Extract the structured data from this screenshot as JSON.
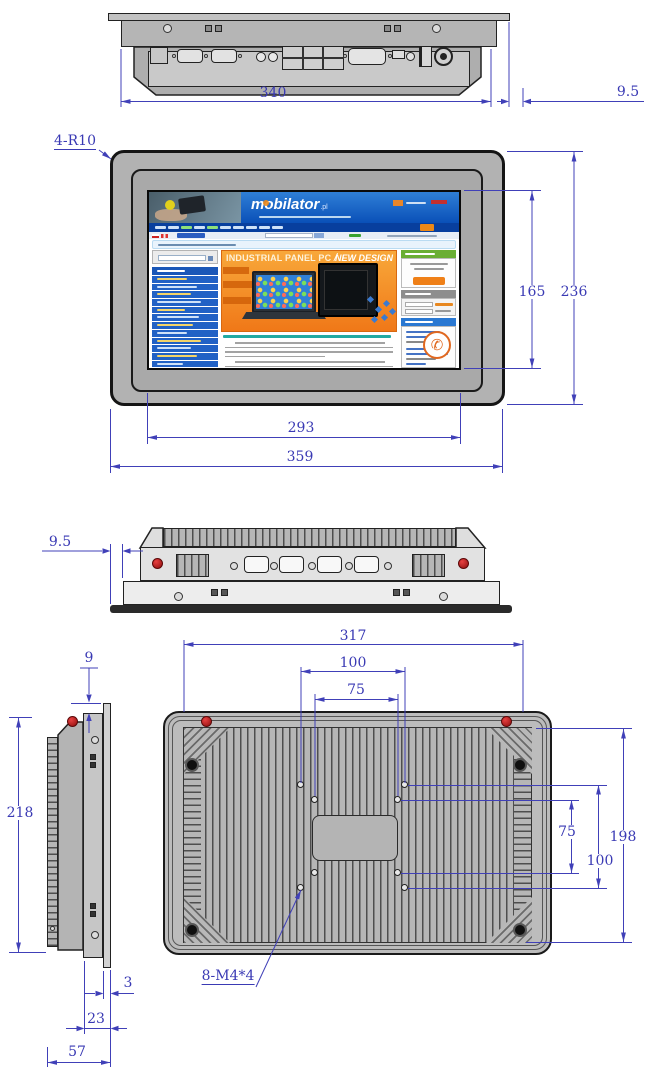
{
  "dims": {
    "top_width": "340",
    "top_lip": "9.5",
    "corner_radius": "4-R10",
    "screen_height": "165",
    "front_height": "236",
    "screen_width": "293",
    "front_width": "359",
    "side_lip": "9.5",
    "rear_offset": "9",
    "side_height": "218",
    "back_width": "317",
    "vesa_top_100": "100",
    "vesa_top_75": "75",
    "vesa_right_75": "75",
    "vesa_right_100": "100",
    "back_height": "198",
    "mount_thread": "8-M4*4",
    "lip_depth": "3",
    "body_depth": "23",
    "total_depth": "57"
  },
  "screen": {
    "logo": "mobilator",
    "logo_tld": ".pl",
    "banner_title": "INDUSTRIAL PANEL PC",
    "banner_divider": "/",
    "banner_subtitle": "NEW DESIGN"
  },
  "icons": {
    "phone": "✆"
  }
}
